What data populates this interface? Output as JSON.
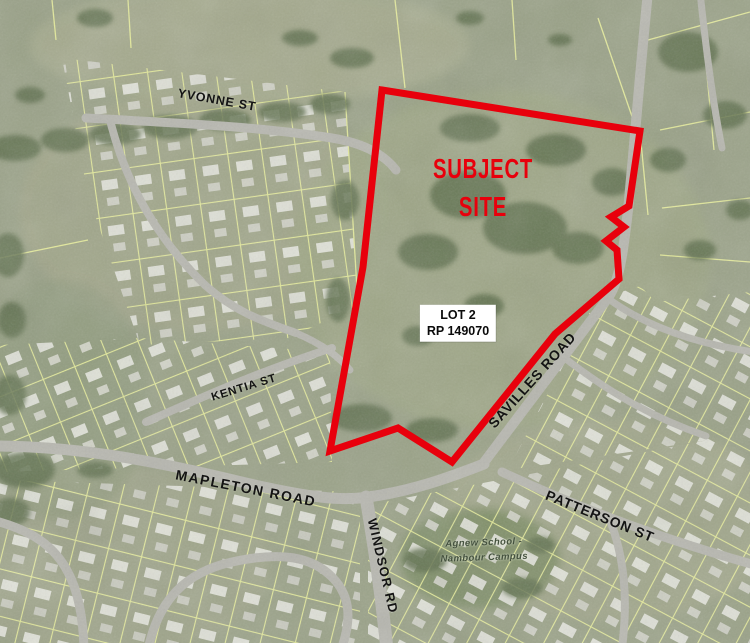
{
  "map": {
    "site": {
      "label_line1": "SUBJECT",
      "label_line2": "SITE",
      "lot_line1": "LOT 2",
      "lot_line2": "RP 149070"
    },
    "streets": {
      "yvonne": "YVONNE ST",
      "kentia": "KENTIA ST",
      "mapleton": "MAPLETON ROAD",
      "windsor": "WINDSOR RD",
      "savilles": "SAVILLES ROAD",
      "patterson": "PATTERSON ST"
    },
    "school": {
      "line1": "Agnew School -",
      "line2": "Nambour Campus"
    },
    "colors": {
      "site_boundary": "#e8000c",
      "subject_text": "#e8000c",
      "street_text": "#141414",
      "cadastral_lines": "#ecf29d",
      "roads": "#b7b7af",
      "terrain_base": "#9aa287"
    }
  }
}
